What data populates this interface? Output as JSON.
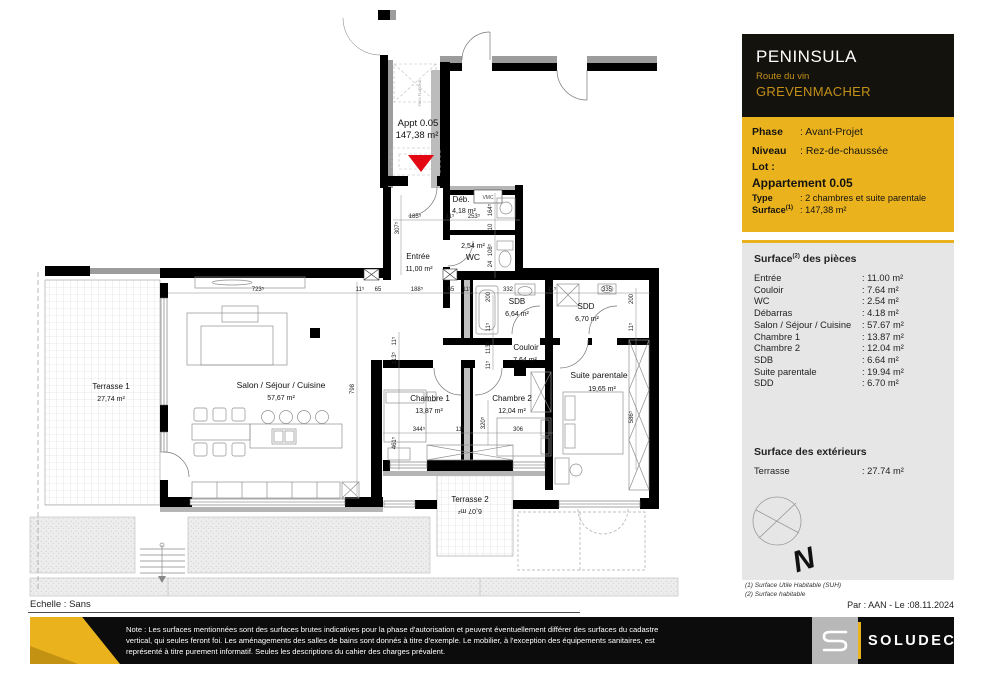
{
  "colors": {
    "accent_yellow": "#EAB31E",
    "gold_text": "#C29019",
    "arrow_red": "#E30613",
    "panel_black": "#14120D",
    "info_gray": "#E6E6E6",
    "wall_black": "#000000"
  },
  "plan": {
    "appt": {
      "label": "Appt 0.05",
      "area": "147,38 m²"
    },
    "rooms": {
      "entree": {
        "name": "Entrée",
        "area": "11,00 m²"
      },
      "debarras": {
        "name": "Déb.",
        "area": "4,18 m²"
      },
      "wc": {
        "name": "WC",
        "area": "2,54 m²"
      },
      "sdb": {
        "name": "SDB",
        "area": "6,64 m²"
      },
      "sdd": {
        "name": "SDD",
        "area": "6,70 m²"
      },
      "couloir": {
        "name": "Couloir",
        "area": "7,64 m²"
      },
      "suite": {
        "name": "Suite parentale",
        "area": "19,65 m²"
      },
      "chambre1": {
        "name": "Chambre 1",
        "area": "13,87 m²"
      },
      "chambre2": {
        "name": "Chambre 2",
        "area": "12,04 m²"
      },
      "salon": {
        "name": "Salon / Séjour / Cuisine",
        "area": "57,67 m²"
      },
      "terrasse1": {
        "name": "Terrasse 1",
        "area": "27,74 m²"
      },
      "terrasse2": {
        "name": "Terrasse 2",
        "area": "6,07 m²"
      }
    },
    "vmc_label": "VMC",
    "ceiling_note": "FAUX PLAFOND",
    "dims": [
      "723⁵",
      "11⁵",
      "65",
      "188⁵",
      "65",
      "11⁵",
      "332",
      "11⁵",
      "335",
      "185⁵",
      "11⁵",
      "253⁵",
      "307⁵",
      "164⁵",
      "10",
      "108⁵",
      "24",
      "200",
      "11⁵",
      "113⁵",
      "11⁵",
      "200",
      "11⁵",
      "586⁵",
      "798",
      "11⁵",
      "113⁵",
      "461⁵",
      "344⁵",
      "11⁵",
      "306",
      "320⁵"
    ]
  },
  "panel": {
    "project": "PENINSULA",
    "street": "Route du vin",
    "city": "GREVENMACHER",
    "phase_label": "Phase",
    "phase_value": ": Avant-Projet",
    "niveau_label": "Niveau",
    "niveau_value": ": Rez-de-chaussée",
    "lot_label": "Lot :",
    "apartment": "Appartement 0.05",
    "type_label": "Type",
    "type_value": ": 2 chambres et suite parentale",
    "surface_label": "Surface",
    "surface_sup": "(1)",
    "surface_value": ": 147,38 m²",
    "pieces_title_a": "Surface",
    "pieces_title_sup": "(2)",
    "pieces_title_b": " des pièces",
    "pieces": [
      {
        "name": "Entrée",
        "value": ": 11.00 m²"
      },
      {
        "name": "Couloir",
        "value": ": 7.64 m²"
      },
      {
        "name": "WC",
        "value": ": 2.54 m²"
      },
      {
        "name": "Débarras",
        "value": ": 4.18 m²"
      },
      {
        "name": "Salon / Séjour / Cuisine",
        "value": ": 57.67 m²"
      },
      {
        "name": "Chambre 1",
        "value": ": 13.87 m²"
      },
      {
        "name": "Chambre 2",
        "value": ": 12.04 m²"
      },
      {
        "name": "SDB",
        "value": ": 6.64 m²"
      },
      {
        "name": "Suite parentale",
        "value": ": 19.94 m²"
      },
      {
        "name": "SDD",
        "value": ": 6.70 m²"
      }
    ],
    "ext_title": "Surface des extérieurs",
    "ext": {
      "name": "Terrasse",
      "value": ": 27.74 m²"
    },
    "north_letter": "N",
    "footnote1": "(1) Surface Utile Habitable (SUH)",
    "footnote2": "(2) Surface habitable",
    "byline": "Par : AAN - Le :08.11.2024"
  },
  "footer": {
    "scale": "Echelle : Sans",
    "note": "Note : Les surfaces mentionnées sont des surfaces brutes indicatives pour la phase d'autorisation et peuvent éventuellement différer des surfaces du cadastre vertical, qui seules feront foi. Les aménagements des salles de bains sont donnés à titre d'exemple. Le mobilier, à l'exception des équipements sanitaires, est représenté à titre purement informatif. Seules les descriptions du cahier des charges prévalent.",
    "logo_text": "SOLUDEC"
  }
}
